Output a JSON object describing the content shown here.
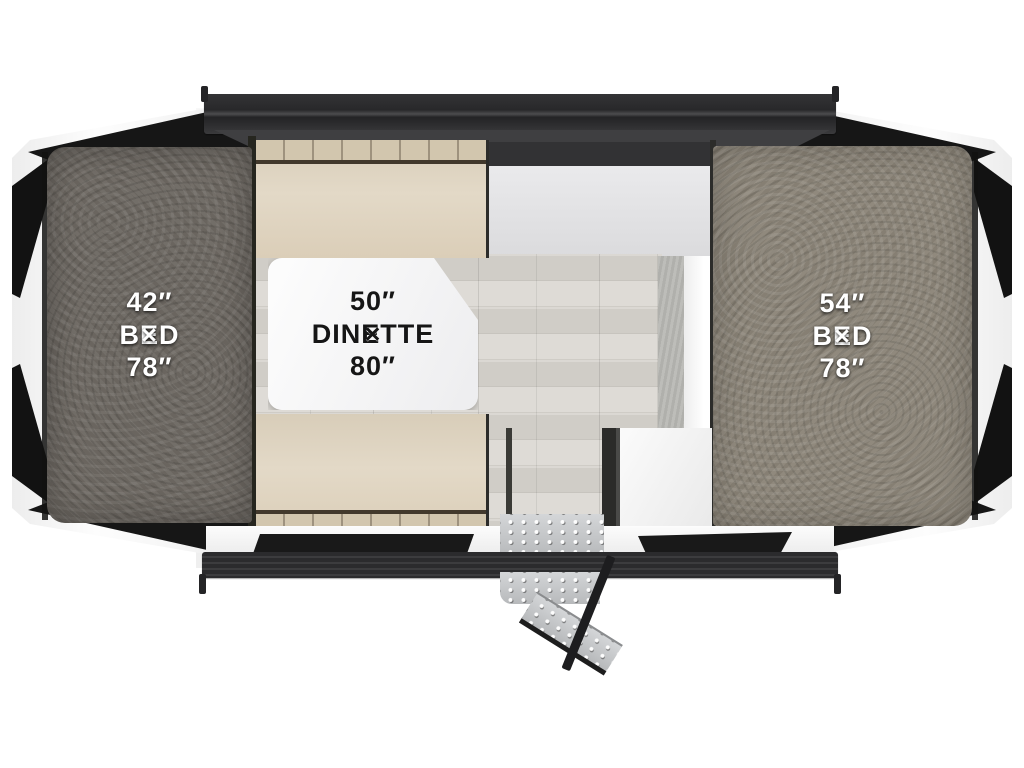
{
  "floorplan": {
    "rooms": [
      {
        "id": "bed-left",
        "label": "BED",
        "dimensions": "42″ × 78″"
      },
      {
        "id": "dinette",
        "label": "DINETTE",
        "dimensions": "50″ × 80″"
      },
      {
        "id": "bed-right",
        "label": "BED",
        "dimensions": "54″ × 78″"
      }
    ],
    "features": [
      "fold-out-bunk-end-left",
      "fold-out-bunk-end-right",
      "dinette-table",
      "bench-seat-front",
      "bench-seat-rear",
      "galley-counter",
      "storage-cabinet",
      "entry-step"
    ],
    "palette": {
      "carpet_dark": "#6e6963",
      "carpet_light": "#8b8478",
      "cushion": "#ddd2bf",
      "table": "#f4f4f6",
      "wood_floor": "#d3d0ca",
      "frame_rail": "#2c2c2e",
      "step_metal": "#c6c8ca",
      "canvas": "#161616"
    }
  }
}
